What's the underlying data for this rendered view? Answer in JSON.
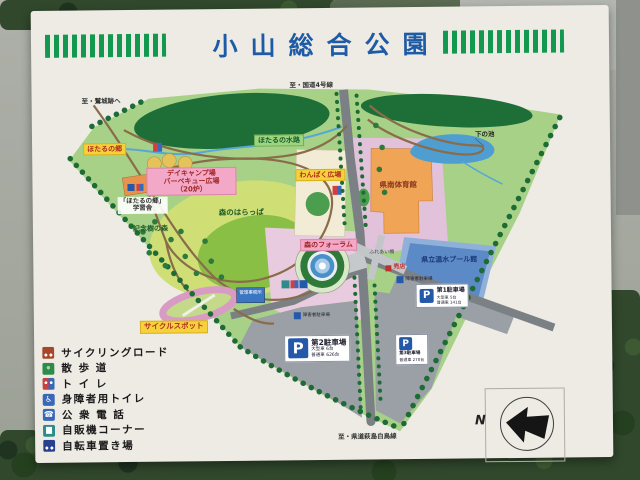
{
  "title": "小山総合公園",
  "directions": {
    "washijo": "至・鷲城跡へ",
    "route4": "至・国道4号線",
    "kendo": "至・県道萩島白鳥線"
  },
  "areas": {
    "hotaru_sato": "ほたるの郷",
    "hotaru_suiro": "ほたるの水路",
    "day_camp": [
      "デイキャンプ場",
      "バーベキュー広場",
      "（20炉）"
    ],
    "gakushusha": [
      "「ほたるの郷」",
      "学習舎"
    ],
    "kinenju": "記念樹の森",
    "mori_harappa": "森のはらっぱ",
    "wanpaku": "わんぱく広場",
    "gym": "県南体育館",
    "shimo_ike": "下の池",
    "forum": "森のフォーラム",
    "pool": "県立温水プール館",
    "fureai_bashi": "ふれあい橋",
    "baiten": "売店",
    "kanri": "管理事務所",
    "cycle_spot": "サイクルスポット",
    "shogaisha_parking": "障害者駐車場"
  },
  "parking": {
    "p1": {
      "name": "第1駐車場",
      "large": "大型車 5台",
      "normal": "普通車 141台"
    },
    "p2": {
      "name": "第2駐車場",
      "large": "大型車 6台",
      "normal": "普通車 626台"
    },
    "p3": {
      "name": "第3駐車場",
      "normal": "普通車 270台"
    }
  },
  "legend": [
    {
      "label": "サイクリングロード",
      "icon": "cycling-road-icon",
      "color": "#a8462a"
    },
    {
      "label": "散 歩 道",
      "icon": "walking-path-icon",
      "color": "#2e8b4a"
    },
    {
      "label": "ト イ レ",
      "icon": "toilet-icon",
      "color": "#3a68b8"
    },
    {
      "label": "身障者用トイレ",
      "icon": "accessible-toilet-icon",
      "color": "#3a68b8"
    },
    {
      "label": "公 衆 電 話",
      "icon": "public-phone-icon",
      "color": "#3a68b8"
    },
    {
      "label": "自販機コーナー",
      "icon": "vending-corner-icon",
      "color": "#2e8b8b"
    },
    {
      "label": "自転車置き場",
      "icon": "bicycle-parking-icon",
      "color": "#27418f"
    }
  ],
  "compass": {
    "north": "N"
  },
  "colors": {
    "title_blue": "#1e5ba6",
    "stripe_green": "#13994f",
    "park_green": "#a6d187",
    "forest_green": "#1e6e38",
    "lawn_yellow_green": "#cfdf75",
    "road_grey": "#7b8085",
    "parking_grey": "#9aa0a5",
    "pond_blue": "#4f9ed2",
    "pool_blue": "#5c8ac6",
    "building_orange": "#f0a455",
    "plaza_pink": "#e2c2da"
  }
}
